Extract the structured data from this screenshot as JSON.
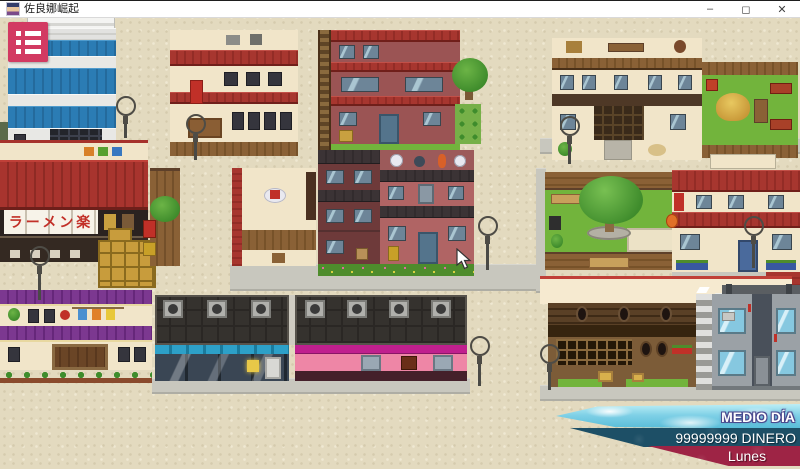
{
  "window": {
    "title": "佐良娜崛起",
    "controls": {
      "minimize": "–",
      "maximize": "◻",
      "close": "✕"
    }
  },
  "menu": {
    "icon": "list-menu-icon"
  },
  "hud": {
    "time_of_day": "MEDIO DÍA",
    "money": "99999999 DINERO",
    "weekday": "Lunes"
  },
  "map": {
    "ramen_sign": "ラーメン楽"
  },
  "colors": {
    "menu_button": "#d23a62",
    "time_banner_sky": "#7fd0e6",
    "money_banner": "#1d4f66",
    "day_banner": "#9e2445",
    "ground": "#e3dabf"
  }
}
